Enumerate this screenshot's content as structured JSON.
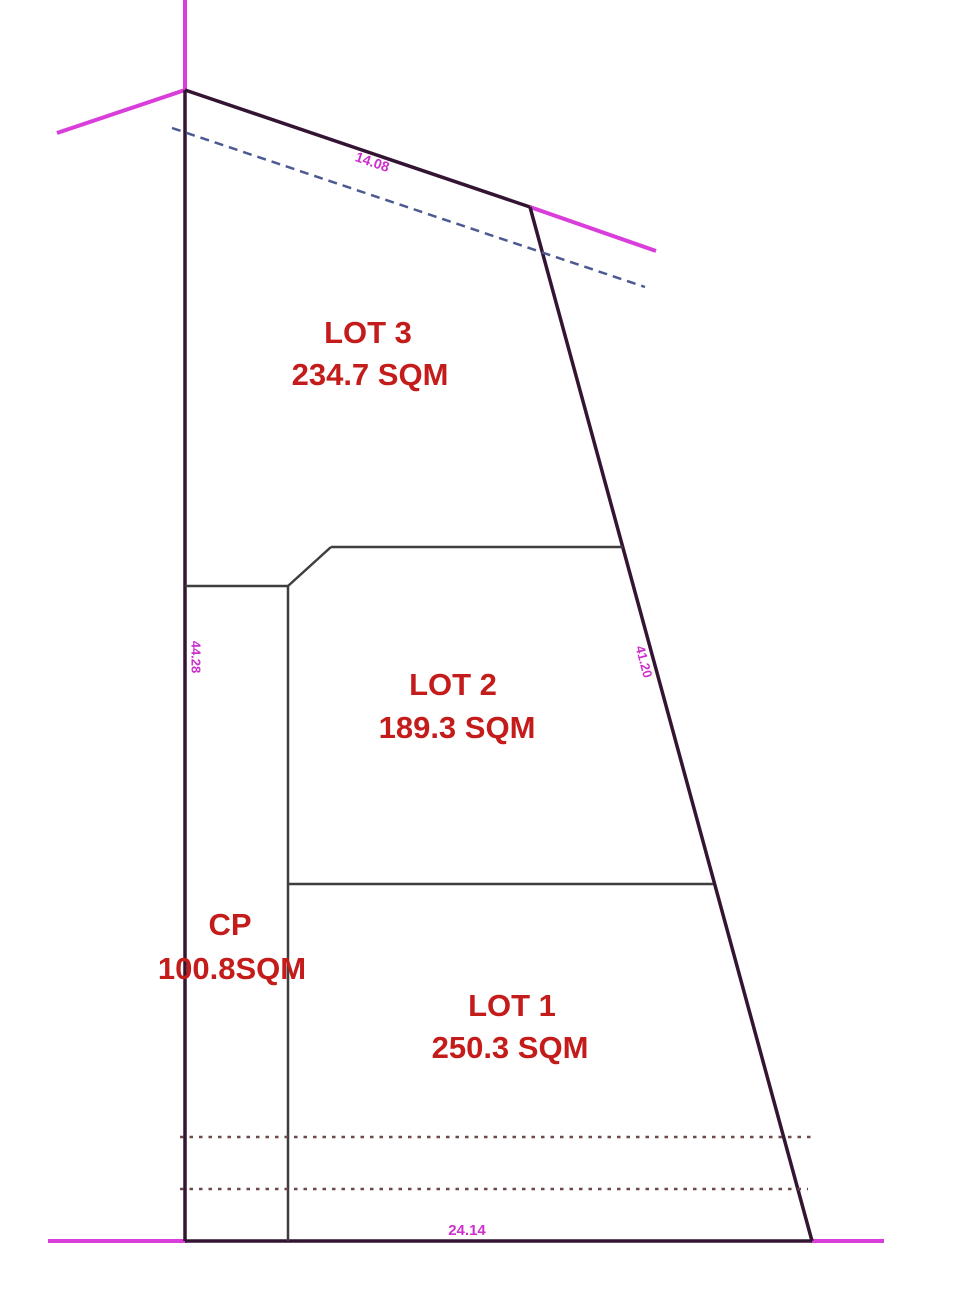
{
  "plan": {
    "canvas": {
      "width": 964,
      "height": 1296,
      "background": "#ffffff"
    },
    "colors": {
      "boundary": "#331433",
      "interior": "#3e3e3e",
      "road": "#da3eda",
      "tie": "#4d5a92",
      "setback": "#6d4848",
      "lot_text": "#c41b1b",
      "dim_text": "#cc2fcc"
    },
    "lots": [
      {
        "id": "lot-3",
        "name": {
          "text": "LOT 3",
          "x": 368,
          "y": 335,
          "size": 31
        },
        "area": {
          "text": "234.7 SQM",
          "x": 370,
          "y": 377,
          "size": 31
        }
      },
      {
        "id": "lot-2",
        "name": {
          "text": "LOT 2",
          "x": 453,
          "y": 687,
          "size": 31
        },
        "area": {
          "text": "189.3 SQM",
          "x": 457,
          "y": 730,
          "size": 31
        }
      },
      {
        "id": "cp",
        "name": {
          "text": "CP",
          "x": 230,
          "y": 927,
          "size": 31
        },
        "area": {
          "text": "100.8SQM",
          "x": 232,
          "y": 971,
          "size": 31
        }
      },
      {
        "id": "lot-1",
        "name": {
          "text": "LOT 1",
          "x": 512,
          "y": 1008,
          "size": 31
        },
        "area": {
          "text": "250.3 SQM",
          "x": 510,
          "y": 1050,
          "size": 31
        }
      }
    ],
    "dimensions": [
      {
        "id": "dim-top-edge",
        "text": "14.08",
        "x": 372,
        "y": 163,
        "rotate": 19,
        "size": 14
      },
      {
        "id": "dim-left-edge",
        "text": "44.28",
        "x": 195,
        "y": 657,
        "rotate": 90,
        "size": 13
      },
      {
        "id": "dim-right-edge",
        "text": "41.20",
        "x": 643,
        "y": 662,
        "rotate": 75,
        "size": 13
      },
      {
        "id": "dim-bottom-edge",
        "text": "24.14",
        "x": 467,
        "y": 1231,
        "rotate": 0,
        "size": 15
      }
    ],
    "lines": [
      {
        "id": "road-line-top-vertical",
        "color": "road",
        "width": 4,
        "x1": 185,
        "y1": 0,
        "x2": 185,
        "y2": 90
      },
      {
        "id": "road-line-top-left-diagonal",
        "color": "road",
        "width": 4,
        "x1": 185,
        "y1": 90,
        "x2": 57,
        "y2": 133
      },
      {
        "id": "road-line-top-right-diagonal",
        "color": "road",
        "width": 4,
        "x1": 530,
        "y1": 207,
        "x2": 656,
        "y2": 251
      },
      {
        "id": "road-line-bottom-left",
        "color": "road",
        "width": 4,
        "x1": 48,
        "y1": 1241,
        "x2": 186,
        "y2": 1241
      },
      {
        "id": "road-line-bottom-right",
        "color": "road",
        "width": 4,
        "x1": 811,
        "y1": 1241,
        "x2": 884,
        "y2": 1241
      },
      {
        "id": "boundary-top",
        "color": "boundary",
        "width": 3.5,
        "x1": 185,
        "y1": 90,
        "x2": 530,
        "y2": 207
      },
      {
        "id": "boundary-right",
        "color": "boundary",
        "width": 3.5,
        "x1": 530,
        "y1": 207,
        "x2": 812,
        "y2": 1241
      },
      {
        "id": "boundary-bottom",
        "color": "boundary",
        "width": 3.5,
        "x1": 185,
        "y1": 1241,
        "x2": 812,
        "y2": 1241
      },
      {
        "id": "boundary-left",
        "color": "boundary",
        "width": 3.5,
        "x1": 185,
        "y1": 90,
        "x2": 185,
        "y2": 1241
      },
      {
        "id": "cp-top-line",
        "color": "interior",
        "width": 2.5,
        "x1": 185,
        "y1": 586,
        "x2": 288,
        "y2": 586
      },
      {
        "id": "lot2-chamfer-line",
        "color": "interior",
        "width": 2.5,
        "x1": 288,
        "y1": 586,
        "x2": 331,
        "y2": 547
      },
      {
        "id": "lot2-top-line",
        "color": "interior",
        "width": 2.5,
        "x1": 331,
        "y1": 547,
        "x2": 623,
        "y2": 547
      },
      {
        "id": "cp-divider-line",
        "color": "interior",
        "width": 2.5,
        "x1": 288,
        "y1": 586,
        "x2": 288,
        "y2": 1241
      },
      {
        "id": "lot1-lot2-divider-line",
        "color": "interior",
        "width": 2.5,
        "x1": 288,
        "y1": 884,
        "x2": 713,
        "y2": 884
      },
      {
        "id": "tie-dashed-line",
        "color": "tie",
        "width": 2.5,
        "x1": 172,
        "y1": 128,
        "x2": 645,
        "y2": 287,
        "dash": "9 6"
      },
      {
        "id": "setback-dotted-upper",
        "color": "setback",
        "width": 2.5,
        "x1": 180,
        "y1": 1137,
        "x2": 816,
        "y2": 1137,
        "dash": "3.5 6"
      },
      {
        "id": "setback-dotted-lower",
        "color": "setback",
        "width": 2.5,
        "x1": 180,
        "y1": 1189,
        "x2": 808,
        "y2": 1189,
        "dash": "3.5 6"
      }
    ]
  }
}
